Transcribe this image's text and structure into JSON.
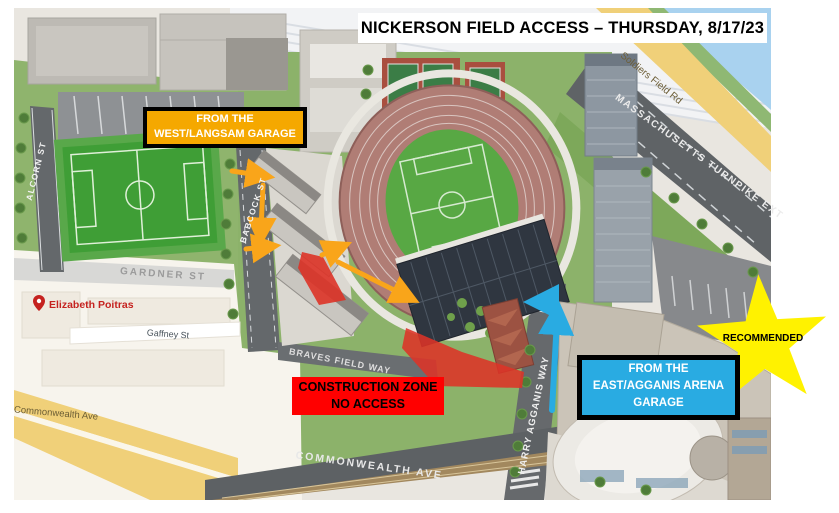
{
  "title": "NICKERSON FIELD ACCESS – THURSDAY, 8/17/23",
  "callouts": {
    "west_garage": {
      "line1": "FROM THE",
      "line2": "WEST/LANGSAM GARAGE"
    },
    "construction": {
      "line1": "CONSTRUCTION ZONE",
      "line2": "NO ACCESS"
    },
    "east_garage": {
      "line1": "FROM THE",
      "line2": "EAST/AGGANIS ARENA",
      "line3": "GARAGE"
    },
    "recommended": "RECOMMENDED"
  },
  "streets": {
    "alcorn": "ALCORN ST",
    "babcock": "BABCOCK ST",
    "gardner": "GARDNER ST",
    "gaffney": "Gaffney St",
    "commonwealth_lower": "Commonwealth Ave",
    "commonwealth_main": "COMMONWEALTH AVE",
    "braves_field_way": "BRAVES FIELD WAY",
    "harry_agganis_way": "HARRY AGGANIS WAY",
    "mass_turnpike": "MASSACHUSETTS TURNPIKE EXT",
    "soldiers_field": "Soldiers Field Rd"
  },
  "poi": {
    "elizabeth_poitras": "Elizabeth Poitras"
  },
  "colors": {
    "west_box": "#F5A800",
    "west_route": "#F9A51A",
    "east_box": "#29ABE2",
    "east_route": "#29ABE2",
    "construction_box": "#FF0000",
    "construction_zone": "#DD3327",
    "star": "#FFF200"
  }
}
